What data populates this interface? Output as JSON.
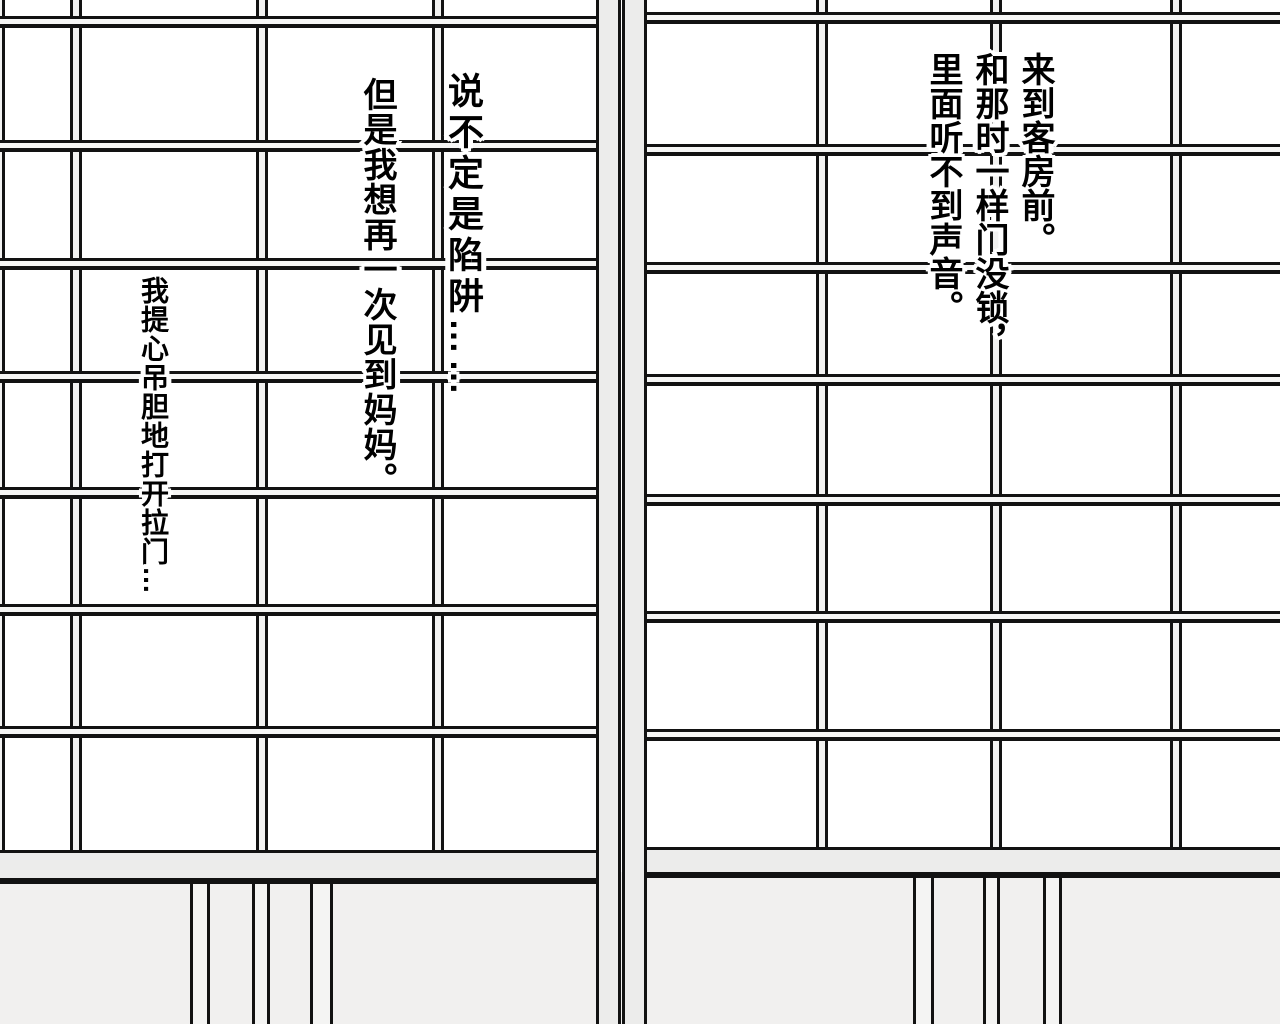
{
  "scene": {
    "kind": "manga-page-panel",
    "description": "Straight-on view of two closed shoji paper sliding doors with wooden lattice; floor strip below; vertical Chinese narration captions",
    "colors": {
      "paper": "#ffffff",
      "frame_gray": "#ececeb",
      "floor_gray": "#f1f0ef",
      "ink": "#121212",
      "caption_halo": "#ffffff"
    }
  },
  "captions": {
    "arrive": {
      "text": "来到客房前。\n和那时一样门没锁，\n里面听不到声音。"
    },
    "trap": {
      "text": "说不定是陷阱……"
    },
    "mother": {
      "text": "但是我想再一次见到妈妈。"
    },
    "open": {
      "text": "我提心吊胆地打开拉门…"
    }
  }
}
